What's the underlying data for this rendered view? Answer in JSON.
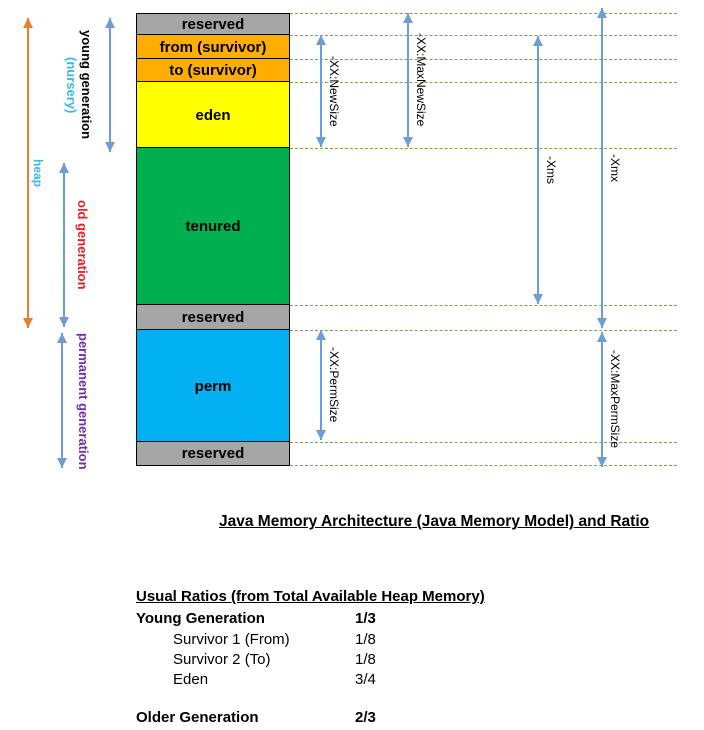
{
  "diagram": {
    "memory_blocks": [
      {
        "name": "reserved-top",
        "label": "reserved",
        "color": "#a6a6a6"
      },
      {
        "name": "from-survivor",
        "label": "from (survivor)",
        "color": "#ffae00"
      },
      {
        "name": "to-survivor",
        "label": "to (survivor)",
        "color": "#ffae00"
      },
      {
        "name": "eden",
        "label": "eden",
        "color": "#ffff00"
      },
      {
        "name": "tenured",
        "label": "tenured",
        "color": "#00b050"
      },
      {
        "name": "reserved-middle",
        "label": "reserved",
        "color": "#a6a6a6"
      },
      {
        "name": "perm",
        "label": "perm",
        "color": "#00b0f0"
      },
      {
        "name": "reserved-bottom",
        "label": "reserved",
        "color": "#a6a6a6"
      }
    ],
    "generation_labels": {
      "heap": "heap",
      "young": "young generation",
      "nursery": "(nursery)",
      "old": "old generation",
      "permanent": "permanent generation"
    },
    "jvm_flags": {
      "new_size": "-XX:NewSize",
      "max_new_size": "-XX:MaxNewSize",
      "xms": "-Xms",
      "xmx": "-Xmx",
      "perm_size": "-XX:PermSize",
      "max_perm_size": "-XX:MaxPermSize"
    },
    "colors": {
      "heap_arrow": "#ed7d31",
      "range_arrows": "#6d9dd1",
      "dashed_guides": "#7ba052",
      "heap_label": "#3eb7e8",
      "nursery_label": "#3eb7e8",
      "old_generation_label": "#ed1c24",
      "permanent_generation_label": "#7030a0"
    }
  },
  "title": "Java Memory Architecture (Java Memory Model) and Ratio",
  "ratios": {
    "heading": "Usual Ratios (from Total Available Heap Memory)",
    "rows": [
      {
        "label": "Young Generation",
        "value": "1/3"
      },
      {
        "label": "Survivor 1 (From)",
        "value": "1/8"
      },
      {
        "label": "Survivor 2 (To)",
        "value": "1/8"
      },
      {
        "label": "Eden",
        "value": "3/4"
      },
      {
        "label": "Older Generation",
        "value": "2/3"
      }
    ]
  }
}
